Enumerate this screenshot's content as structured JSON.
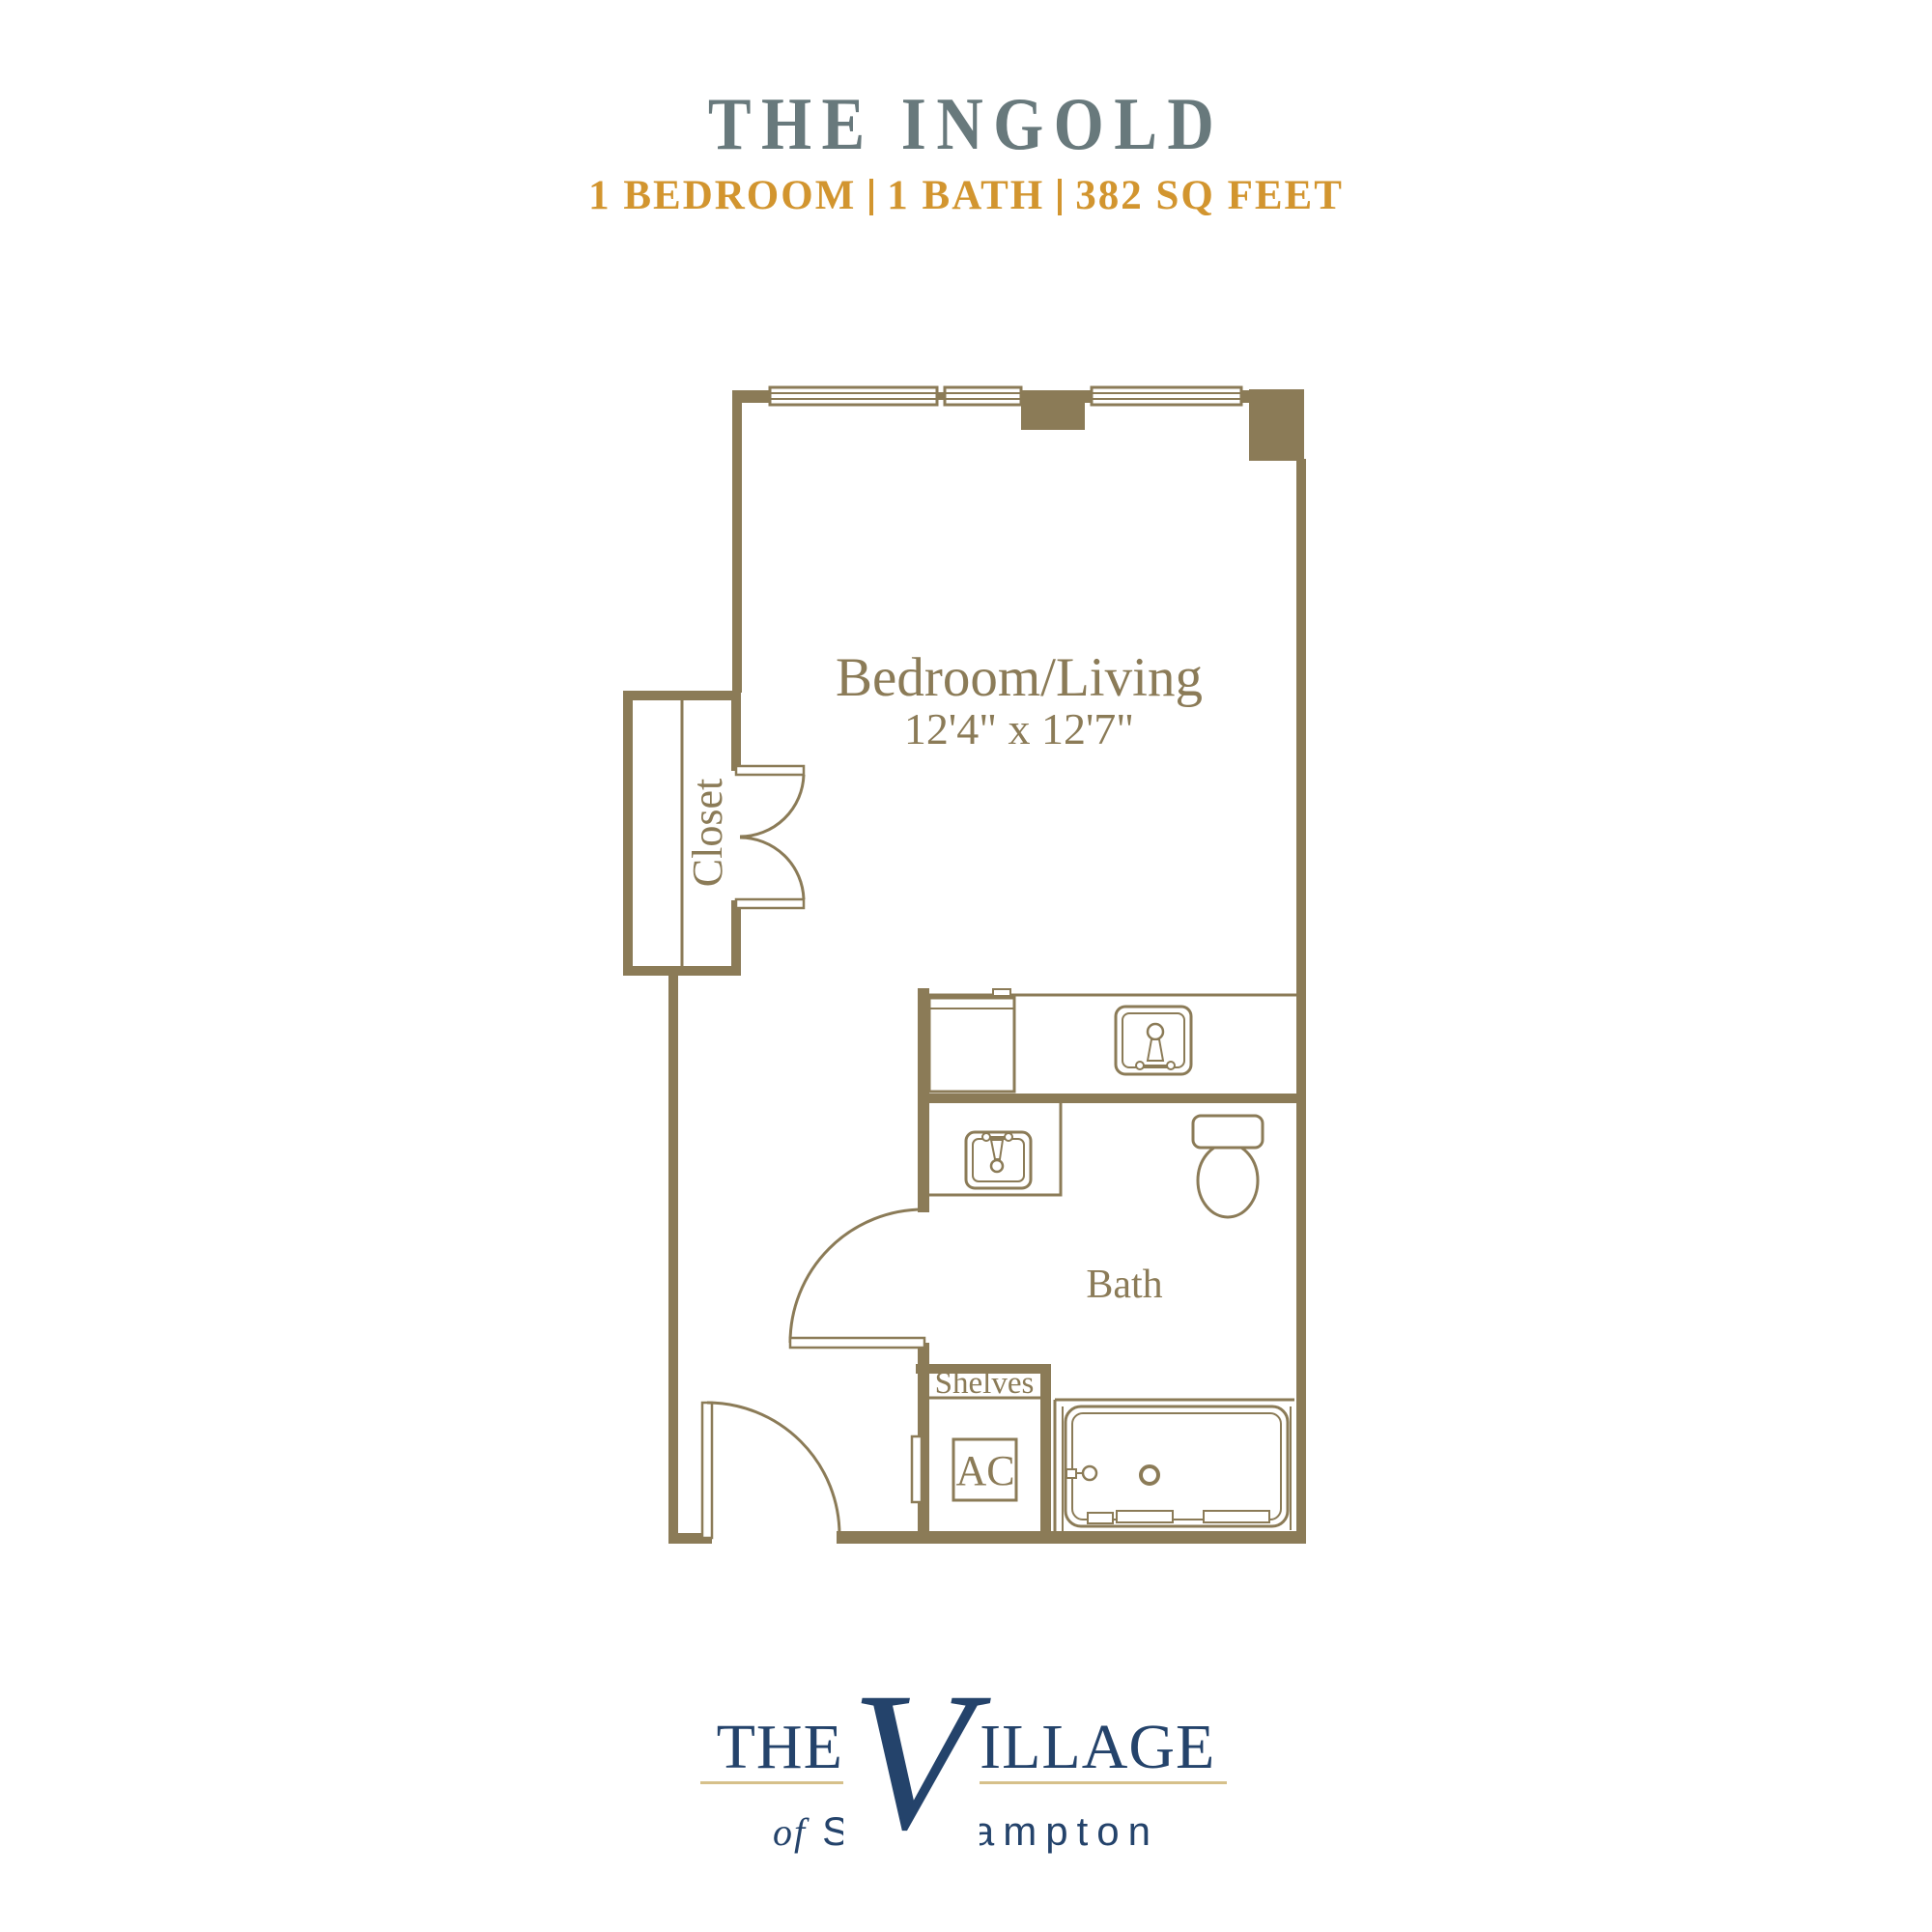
{
  "header": {
    "title": "THE INGOLD",
    "specs": [
      "1 BEDROOM",
      "1 BATH",
      "382 SQ FEET"
    ]
  },
  "floorplan": {
    "bedroom_label": "Bedroom/Living",
    "bedroom_dimensions": "12'4\" x 12'7\"",
    "bath_label": "Bath",
    "closet_label": "Closet",
    "shelves_label": "Shelves",
    "ac_label": "AC"
  },
  "logo": {
    "word_the": "THE",
    "word_v_initial": "V",
    "word_illage": "ILLAGE",
    "sub_of": "of",
    "sub_place": "Southampton"
  },
  "colors": {
    "wall_gold": "#8b7b57",
    "title_slate": "#68797c",
    "spec_amber": "#d2952f",
    "logo_navy": "#24436b",
    "logo_rule_gold": "#d6c08a"
  }
}
